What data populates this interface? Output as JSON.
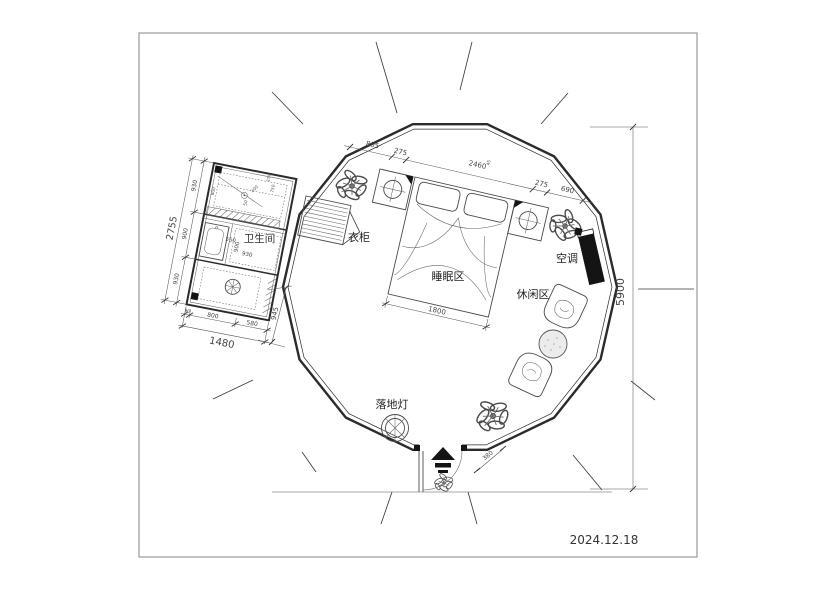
{
  "frame": {
    "date": "2024.12.18"
  },
  "labels": {
    "bathroom": "卫生间",
    "wardrobe": "衣柜",
    "sleeping_area": "睡眠区",
    "leisure_area": "休闲区",
    "air_conditioner": "空调",
    "floor_lamp": "落地灯"
  },
  "dimensions": {
    "top_chain": [
      "805",
      "275",
      "2460",
      "45",
      "275",
      "690"
    ],
    "right_overall": "5900",
    "bed_width": "1800",
    "entry_step": "380",
    "bathroom_left_overall": "2755",
    "bathroom_left_chain": [
      "930",
      "900",
      "930"
    ],
    "bathroom_bottom_chain": [
      "90",
      "800",
      "580"
    ],
    "bathroom_bottom_overall": "1480",
    "bathroom_right": "945",
    "bathroom_inner": [
      "550",
      "900",
      "930",
      "150",
      "750",
      "400",
      "800",
      "50"
    ]
  },
  "colors": {
    "wall": "#2b2b2b",
    "furniture_line": "#4a4a4a",
    "dimension_line": "#555555",
    "ac_fill": "#141414",
    "frame_border": "#9a9a9a",
    "paper": "#ffffff"
  }
}
